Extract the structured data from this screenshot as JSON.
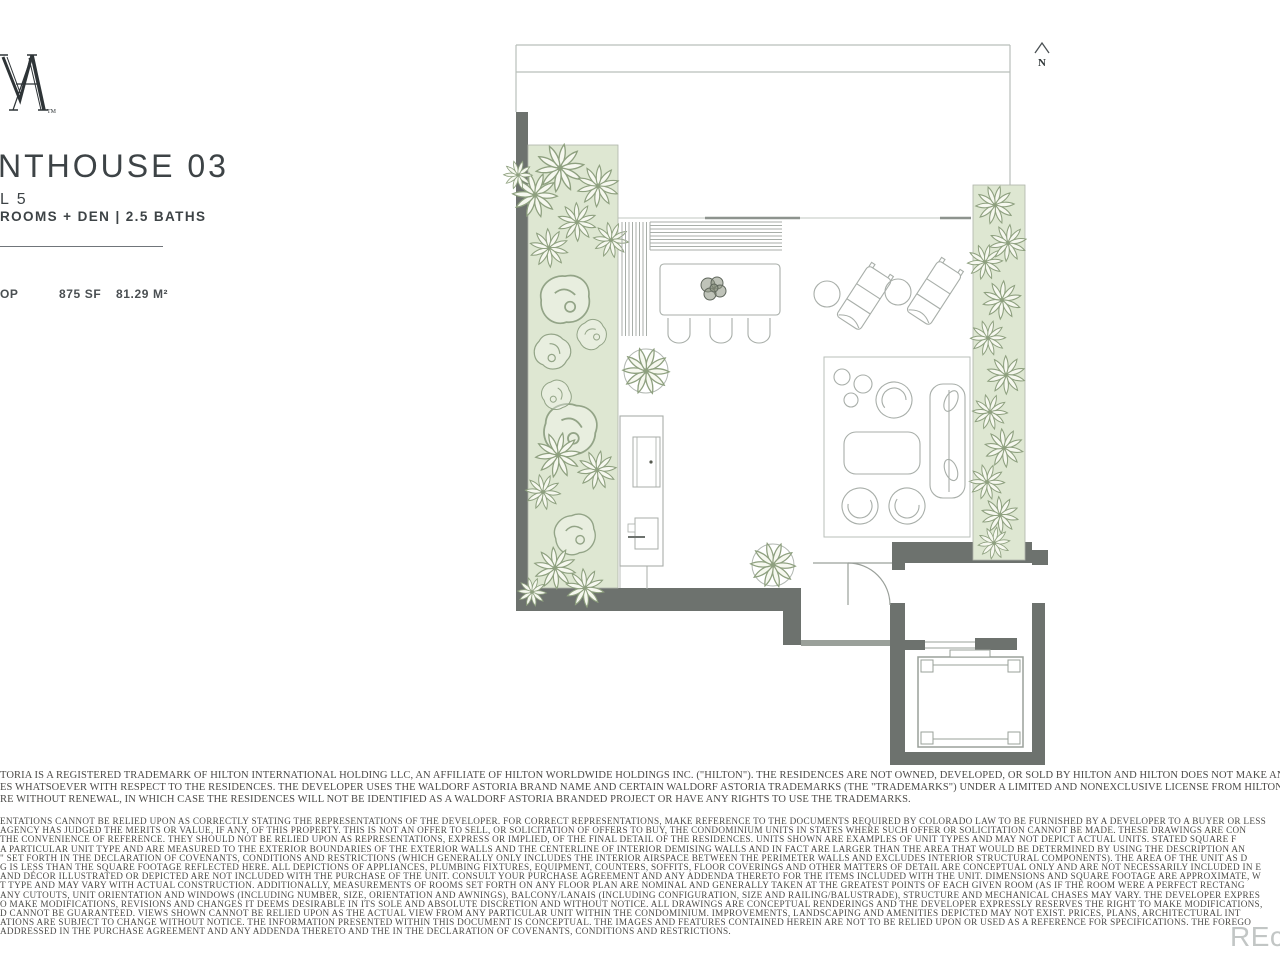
{
  "logo": {
    "name": "waldorf-astoria-monogram",
    "tm": "TM"
  },
  "header": {
    "title": "NTHOUSE 03",
    "level": "L 5",
    "rooms": "ROOMS + DEN | 2.5 BATHS",
    "stats": {
      "fragment": "OP",
      "area_sf": "875 SF",
      "area_m2": "81.29 M²"
    }
  },
  "plan": {
    "north_label": "N",
    "features": [
      "rooftop terrace",
      "planter-left",
      "hedge-right",
      "banquette",
      "dining-table",
      "dining-chairs",
      "chaise-lounges",
      "side-tables",
      "lounge-rug",
      "barrel-chairs",
      "coffee-table",
      "sofa",
      "outdoor-kitchen",
      "grill",
      "sink",
      "round-planters",
      "entry-door",
      "elevator"
    ],
    "colors": {
      "wall": "#6d726e",
      "wall_light": "#9aa09a",
      "planting_fill": "#dee7d2",
      "plant_stroke": "#8ea07f",
      "line": "#a8aea9",
      "text": "#3d4346"
    }
  },
  "disclaimers": {
    "p1": [
      "TORIA IS A REGISTERED TRADEMARK OF HILTON INTERNATIONAL HOLDING LLC, AN AFFILIATE OF HILTON WORLDWIDE HOLDINGS INC. (\"HILTON\"). THE RESIDENCES ARE NOT OWNED, DEVELOPED, OR SOLD BY HILTON AND HILTON DOES NOT MAKE ANY REPRESENTATIONS",
      "ES WHATSOEVER WITH RESPECT TO THE RESIDENCES. THE DEVELOPER USES THE WALDORF ASTORIA BRAND NAME AND CERTAIN WALDORF ASTORIA TRADEMARKS (THE \"TRADEMARKS\") UNDER A LIMITED AND NONEXCLUSIVE LICENSE FROM HILTON. THE LICENSE MAY B",
      "RE WITHOUT RENEWAL, IN WHICH CASE THE RESIDENCES WILL NOT BE IDENTIFIED AS A WALDORF ASTORIA BRANDED PROJECT OR HAVE ANY RIGHTS TO USE THE TRADEMARKS."
    ],
    "p2": [
      "ENTATIONS CANNOT BE RELIED UPON AS CORRECTLY STATING THE REPRESENTATIONS OF THE DEVELOPER. FOR CORRECT REPRESENTATIONS, MAKE REFERENCE TO THE DOCUMENTS REQUIRED BY COLORADO LAW TO BE FURNISHED BY A DEVELOPER TO A BUYER OR LESS",
      "AGENCY HAS JUDGED THE MERITS OR VALUE, IF ANY, OF THIS PROPERTY. THIS IS NOT AN OFFER TO SELL, OR SOLICITATION OF OFFERS TO BUY, THE CONDOMINIUM UNITS IN STATES WHERE SUCH OFFER OR SOLICITATION CANNOT BE MADE. THESE DRAWINGS ARE CON",
      "THE CONVENIENCE OF REFERENCE. THEY SHOULD NOT BE RELIED UPON AS REPRESENTATIONS, EXPRESS OR IMPLIED, OF THE FINAL DETAIL OF THE RESIDENCES. UNITS SHOWN ARE EXAMPLES OF UNIT TYPES AND MAY NOT DEPICT ACTUAL UNITS. STATED SQUARE F",
      "A PARTICULAR UNIT TYPE AND ARE MEASURED TO THE EXTERIOR BOUNDARIES OF THE EXTERIOR WALLS AND THE CENTERLINE OF INTERIOR DEMISING WALLS AND IN FACT ARE LARGER THAN THE AREA THAT WOULD BE DETERMINED BY USING THE DESCRIPTION AN",
      "\" SET FORTH IN THE DECLARATION OF COVENANTS, CONDITIONS AND RESTRICTIONS (WHICH GENERALLY ONLY INCLUDES THE INTERIOR AIRSPACE BETWEEN THE PERIMETER WALLS AND EXCLUDES INTERIOR STRUCTURAL COMPONENTS). THE AREA OF THE UNIT AS D",
      "G IS LESS THAN THE SQUARE FOOTAGE REFLECTED HERE. ALL DEPICTIONS OF APPLIANCES, PLUMBING FIXTURES, EQUIPMENT, COUNTERS, SOFFITS, FLOOR COVERINGS AND OTHER MATTERS OF DETAIL ARE CONCEPTUAL ONLY AND ARE NOT NECESSARILY INCLUDED IN E",
      "AND DÉCOR ILLUSTRATED OR DEPICTED ARE NOT INCLUDED WITH THE PURCHASE OF THE UNIT. CONSULT YOUR PURCHASE AGREEMENT AND ANY ADDENDA THERETO FOR THE ITEMS INCLUDED WITH THE UNIT. DIMENSIONS AND SQUARE FOOTAGE ARE APPROXIMATE, W",
      "T TYPE AND MAY VARY WITH ACTUAL CONSTRUCTION. ADDITIONALLY, MEASUREMENTS OF ROOMS SET FORTH ON ANY FLOOR PLAN ARE NOMINAL AND GENERALLY TAKEN AT THE GREATEST POINTS OF EACH GIVEN ROOM (AS IF THE ROOM WERE A PERFECT RECTANG",
      "ANY CUTOUTS, UNIT ORIENTATION AND WINDOWS (INCLUDING NUMBER, SIZE, ORIENTATION AND AWNINGS), BALCONY/LANAIS (INCLUDING CONFIGURATION, SIZE AND RAILING/BALUSTRADE), STRUCTURE AND MECHANICAL CHASES MAY VARY. THE DEVELOPER EXPRES",
      "O MAKE MODIFICATIONS, REVISIONS AND CHANGES IT DEEMS DESIRABLE IN ITS SOLE AND ABSOLUTE DISCRETION AND WITHOUT NOTICE. ALL DRAWINGS ARE CONCEPTUAL RENDERINGS AND THE DEVELOPER EXPRESSLY RESERVES THE RIGHT TO MAKE MODIFICATIONS,",
      "D CANNOT BE GUARANTEED. VIEWS SHOWN CANNOT BE RELIED UPON AS THE ACTUAL VIEW FROM ANY PARTICULAR UNIT WITHIN THE CONDOMINIUM. IMPROVEMENTS, LANDSCAPING AND AMENITIES DEPICTED MAY NOT EXIST. PRICES, PLANS, ARCHITECTURAL INT",
      "ATIONS ARE SUBJECT TO CHANGE WITHOUT NOTICE. THE INFORMATION PRESENTED WITHIN THIS DOCUMENT IS CONCEPTUAL. THE IMAGES AND FEATURES CONTAINED HEREIN ARE NOT TO BE RELIED UPON OR USED AS A REFERENCE FOR SPECIFICATIONS. THE FOREGO",
      "ADDRESSED IN THE PURCHASE AGREEMENT AND ANY ADDENDA THERETO AND THE IN THE DECLARATION OF COVENANTS, CONDITIONS AND RESTRICTIONS."
    ]
  },
  "watermark": {
    "text": "REc"
  }
}
